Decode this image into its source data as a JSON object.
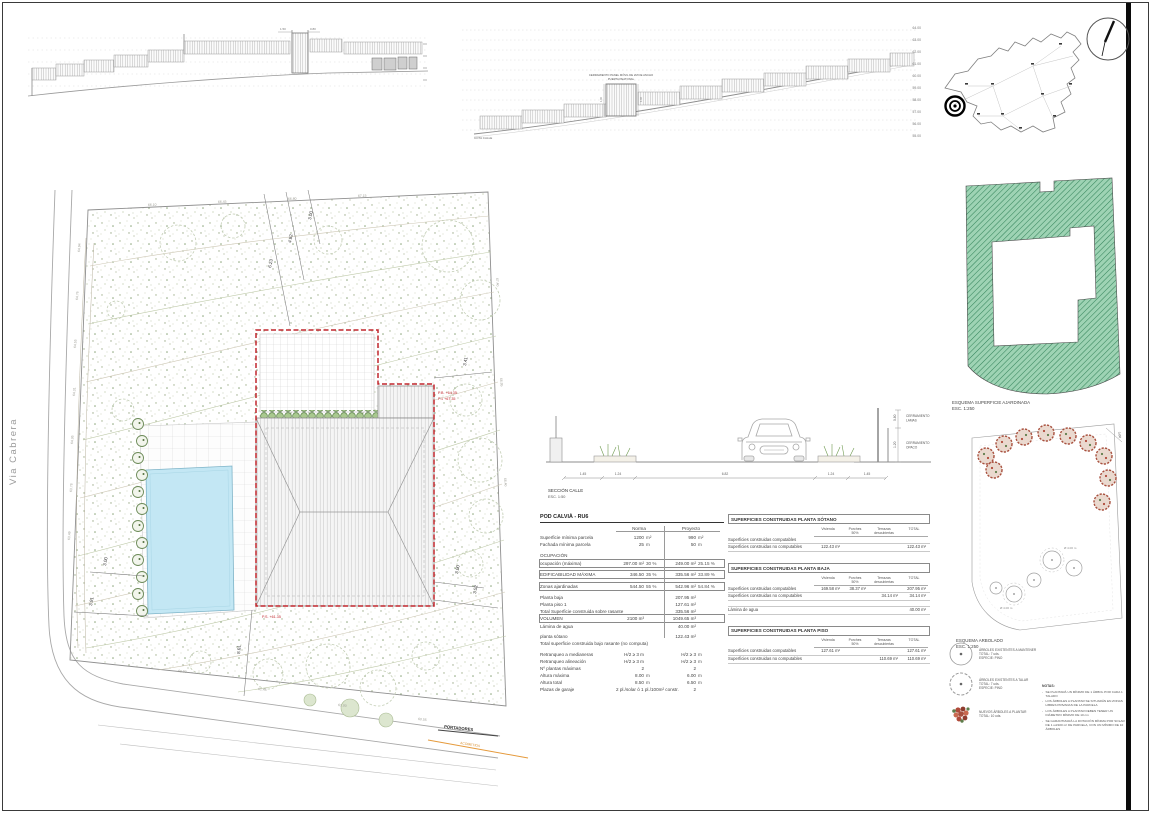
{
  "colors": {
    "accent_red": "#c1272d",
    "pool_blue": "#c3e7f4",
    "garden_green": "#9ed3b4",
    "hatch_green": "#35855c",
    "new_tree": "#a8503e",
    "utility_orange": "#e59a3c"
  },
  "sheet": {
    "street_label": "Via Cabrera"
  },
  "elev1": {
    "dim_left": "1.50",
    "dim_right": "0.80"
  },
  "elev2": {
    "gate_note_1": "CERRAMIENTO PANEL MÓVIL DE 2M DE ANCHO",
    "gate_note_2": "PUERTA PEATONAL",
    "gate_dim_left": "1.00",
    "gate_dim_right": "1.00",
    "bottom_label": "COTA CALLE",
    "levels": [
      "64.00",
      "63.00",
      "62.00",
      "61.00",
      "60.00",
      "59.00",
      "58.00",
      "57.00",
      "56.00",
      "55.00"
    ]
  },
  "plan": {
    "dims": {
      "top1": "3.00",
      "top2": "4.82",
      "top3": "6.23",
      "right_top": "3.41",
      "right_b1": "3.00",
      "right_b2": "3.52",
      "left1": "3.00",
      "left2": "3.91",
      "bottom": "8.01"
    },
    "levels": {
      "pb": "P.B. +64.35",
      "p1": "P.1 +67.35",
      "ps": "P.S. +61.35"
    },
    "spot": [
      "64.94",
      "64.76",
      "64.55",
      "64.31",
      "64.05",
      "63.78",
      "63.49",
      "66.10",
      "66.45",
      "66.80",
      "67.15",
      "67.40",
      "66.95",
      "66.40",
      "61.90",
      "61.45",
      "61.00",
      "60.55"
    ],
    "portadores": "PORTADORES",
    "acometida": "ACOMETIDA"
  },
  "street_section": {
    "caption": "SECCIÓN CALLE",
    "scale": "ESC. 1:50",
    "dims": [
      "1.45",
      "1.24",
      "6.82",
      "1.24",
      "1.45"
    ],
    "v_dims": [
      "0.80",
      "1.20"
    ],
    "label1a": "CERRAMIENTO",
    "label1b": "LAMAS",
    "label2a": "CERRAMIENTO",
    "label2b": "OPACO"
  },
  "norm_table": {
    "title": "POD CALVIÀ - RU6",
    "col_norma": "Norma",
    "col_proyecto": "Proyecto",
    "rows": [
      {
        "label": "Superficie mínima parcela",
        "n1": "1200",
        "n2": "m²",
        "p1": "990",
        "p2": "m²"
      },
      {
        "label": "Fachada mínima parcela",
        "n1": "25",
        "n2": "m",
        "p1": "50",
        "p2": "m"
      },
      {
        "label": "OCUPACIÓN",
        "cls": "section"
      },
      {
        "label": "ocupación (máxima)",
        "n1": "297.00 m²",
        "n2": "30 %",
        "p1": "249.00 m²",
        "p2": "25.15 %",
        "cls": "boxed"
      },
      {
        "label": "",
        "cls": "spacer"
      },
      {
        "label": "EDIFICABILIDAD MÁXIMA",
        "n1": "346.50",
        "n2": "35 %",
        "p1": "335.56 m²",
        "p2": "33.89 %",
        "cls": "boxed"
      },
      {
        "label": "",
        "cls": "spacer"
      },
      {
        "label": "Zonas ajardinadas",
        "n1": "544.50",
        "n2": "55 %",
        "p1": "542.96 m²",
        "p2": "54.84 %",
        "cls": "boxed"
      },
      {
        "label": "",
        "cls": "spacer"
      },
      {
        "label": "Planta baja",
        "p1": "207.95 m²"
      },
      {
        "label": "Planta piso 1",
        "p1": "127.61 m²"
      },
      {
        "label": "Total Superficie construida sobre rasante",
        "p1": "335.56 m²"
      },
      {
        "label": "VOLUMEN",
        "n1": "2100 m³",
        "p1": "1049.65 m³",
        "cls": "boxed"
      },
      {
        "label": "Lámina de agua",
        "p1": "40.00 m²"
      },
      {
        "label": "",
        "cls": "spacer"
      },
      {
        "label": "planta sótano",
        "p1": "122.43 m²"
      },
      {
        "label": "Total superficie construida bajo rasante (no computa)",
        "cls": "wide"
      },
      {
        "label": "",
        "cls": "spacer"
      },
      {
        "label": "Retranqueo a medianeras",
        "n1": "H/2 ≥ 3 m",
        "p1": "H/2 ≥ 3",
        "p2": "m"
      },
      {
        "label": "Retranqueo alineación",
        "n1": "H/2 ≥ 3 m",
        "p1": "H/2 ≥ 3",
        "p2": "m"
      },
      {
        "label": "Nº plantas máximas",
        "n1": "2",
        "p1": "2"
      },
      {
        "label": "Altura máxima",
        "n1": "8.00",
        "n2": "m",
        "p1": "6.00",
        "p2": "m"
      },
      {
        "label": "Altura total",
        "n1": "8.50",
        "n2": "m",
        "p1": "6.50",
        "p2": "m"
      },
      {
        "label": "Plazas de garaje",
        "n1": "2 pl./solar ó 1 pl./100m² constr.",
        "p1": "2"
      }
    ]
  },
  "built_tables": [
    {
      "title": "SUPERFICIES CONSTRUIDAS PLANTA SÓTANO",
      "cols": [
        "Vivienda",
        "Porches\n50%",
        "Terrazas\ndescubiertas",
        "TOTAL"
      ],
      "rows": [
        {
          "label": "Superficies construidas computables",
          "c1": "",
          "c2": "",
          "c3": "",
          "c4": ""
        },
        {
          "label": "Superficies construidas no computables",
          "c1": "122.43 m²",
          "c2": "",
          "c3": "",
          "c4": "122.43 m²"
        }
      ]
    },
    {
      "title": "SUPERFICIES CONSTRUIDAS PLANTA BAJA",
      "cols": [
        "Vivienda",
        "Porches\n50%",
        "Terrazas\ndescubiertas",
        "TOTAL"
      ],
      "rows": [
        {
          "label": "Superficies construidas computables",
          "c1": "169.58 m²",
          "c2": "38.37 m²",
          "c3": "",
          "c4": "207.95 m²"
        },
        {
          "label": "Superficies construidas no computables",
          "c1": "",
          "c2": "",
          "c3": "34.14 m²",
          "c4": "34.14 m²"
        },
        {
          "label": "Lámina de agua",
          "c1": "",
          "c2": "",
          "c3": "",
          "c4": "40.00 m²",
          "cls": "gap"
        }
      ]
    },
    {
      "title": "SUPERFICIES CONSTRUIDAS PLANTA PISO",
      "cols": [
        "Vivienda",
        "Porches\n50%",
        "Terrazas\ndescubiertas",
        "TOTAL"
      ],
      "rows": [
        {
          "label": "Superficies construidas computables",
          "c1": "127.61 m²",
          "c2": "",
          "c3": "",
          "c4": "127.61 m²"
        },
        {
          "label": "Superficies construidas no computables",
          "c1": "",
          "c2": "",
          "c3": "110.69 m²",
          "c4": "110.69 m²"
        }
      ]
    }
  ],
  "ajardinada": {
    "caption": "ESQUEMA SUPERFICIE AJARDINADA",
    "scale": "ESC. 1:250"
  },
  "arbolado": {
    "caption": "ESQUEMA ARBOLADO",
    "scale": "ESC. 1:250",
    "dim": "3.00",
    "dia1": "Ø 4.00 m",
    "dia2": "Ø 4.00 m"
  },
  "legend": {
    "items": [
      {
        "line1": "ÁRBOLES EXISTENTES A MANTENER",
        "line2": "TOTAL: 7 uds.",
        "line3": "ESPECIE: PINO"
      },
      {
        "line1": "ÁRBOLES EXISTENTES A TALAR",
        "line2": "TOTAL: 7 uds.",
        "line3": "ESPECIE: PINO"
      },
      {
        "line1": "NUEVOS ÁRBOLES A PLANTAR",
        "line2": "TOTAL: 10 uds.",
        "line3": ""
      }
    ],
    "notas_title": "NOTAS:",
    "notes": [
      "SE PLANTARÁ UN MÍNIMO DE 1 ÁRBOL POR CADA 1 TALADO",
      "LOS ÁRBOLES A PLANTAR SE SITUARÁN EN ZONAS LIBRES PRIVADAS DE LA PARCELA",
      "LOS ÁRBOLES A PLANTAR DEBEN TENER UN DIÁMETRO MÍNIMO DE 10 cm",
      "SE GARANTIZARÁ LA DOTACIÓN MÍNIMA POR SOLAR DE 1 ud/100 m² DE PARCELA, CON UN MÍNIMO DE 10 ÁRBOLES"
    ]
  }
}
